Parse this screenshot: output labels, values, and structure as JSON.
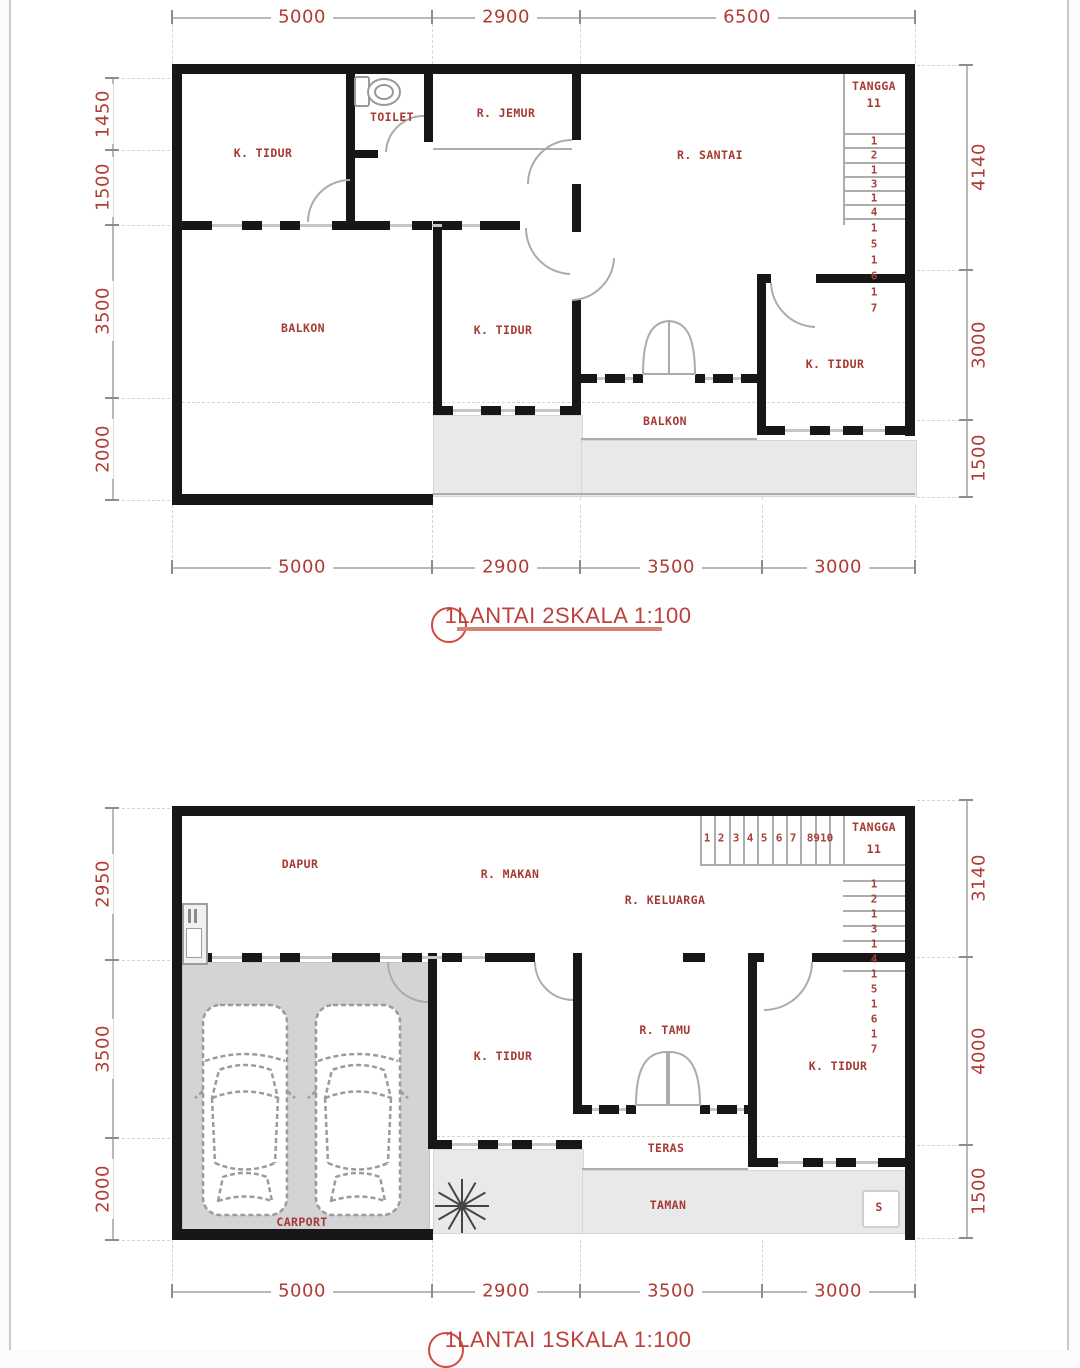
{
  "colors": {
    "accent_red": "#a53a34",
    "dim_red": "#b23c35",
    "wall_black": "#171717",
    "gray_light": "#e9e9e9",
    "gray_carport": "#d4d4d6"
  },
  "plan2": {
    "title": "1LANTAI 2SKALA 1:100",
    "rooms": [
      "K. TIDUR",
      "TOILET",
      "R. JEMUR",
      "R. SANTAI",
      "BALKON",
      "K. TIDUR",
      "K. TIDUR",
      "BALKON"
    ],
    "stair": {
      "label": "TANGGA",
      "landing_number": "11",
      "steps": [
        "1",
        "2",
        "1",
        "3",
        "1",
        "4",
        "1",
        "5",
        "1",
        "6",
        "1",
        "7"
      ]
    },
    "dims": {
      "top": [
        "5000",
        "2900",
        "6500"
      ],
      "bottom": [
        "5000",
        "2900",
        "3500",
        "3000"
      ],
      "left": [
        "1450",
        "1500",
        "3500",
        "2000"
      ],
      "right": [
        "4140",
        "3000",
        "1500"
      ]
    }
  },
  "plan1": {
    "title": "1LANTAI 1SKALA 1:100",
    "rooms": [
      "DAPUR",
      "R. MAKAN",
      "R. KELUARGA",
      "K. TIDUR",
      "R. TAMU",
      "K. TIDUR",
      "TERAS",
      "TAMAN",
      "CARPORT"
    ],
    "stair": {
      "label": "TANGGA",
      "landing_number": "11",
      "run_numbers": [
        "1",
        "2",
        "3",
        "4",
        "5",
        "6",
        "7",
        "8910"
      ],
      "steps": [
        "1",
        "2",
        "1",
        "3",
        "1",
        "4",
        "1",
        "5",
        "1",
        "6",
        "1",
        "7"
      ]
    },
    "marker_s": "S",
    "dims": {
      "bottom": [
        "5000",
        "2900",
        "3500",
        "3000"
      ],
      "left": [
        "2950",
        "3500",
        "2000"
      ],
      "right": [
        "3140",
        "4000",
        "1500"
      ]
    }
  }
}
